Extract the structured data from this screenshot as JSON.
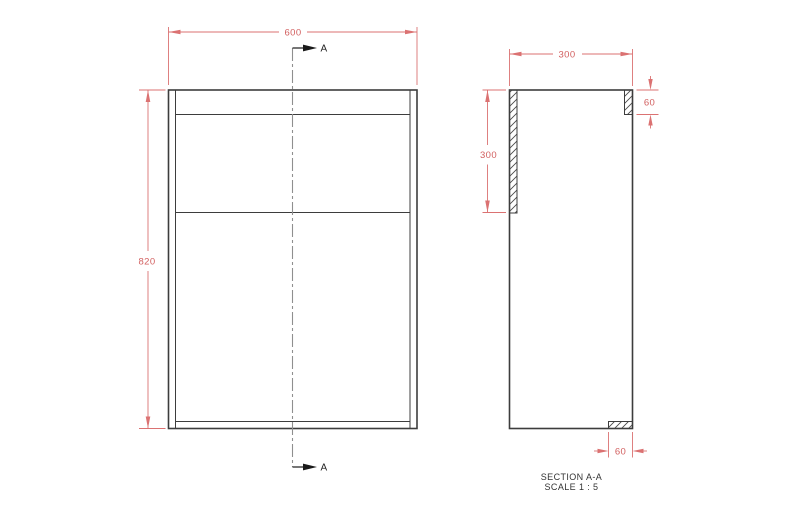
{
  "front_view": {
    "width_dim": "600",
    "height_dim": "820",
    "section_label_top": "A",
    "section_label_bottom": "A"
  },
  "section_view": {
    "width_dim": "300",
    "side_depth_dim": "300",
    "top_thickness_dim": "60",
    "bottom_thickness_dim": "60"
  },
  "caption": {
    "title": "SECTION A-A",
    "scale": "SCALE 1 : 5"
  },
  "colors": {
    "dimension_red": "#db7272",
    "dimension_text_red": "#d25f5f",
    "geometry": "#3d3d3d",
    "centerline": "#8f8f8f",
    "section_arrow": "#1a1a1a",
    "background": "#ffffff"
  }
}
